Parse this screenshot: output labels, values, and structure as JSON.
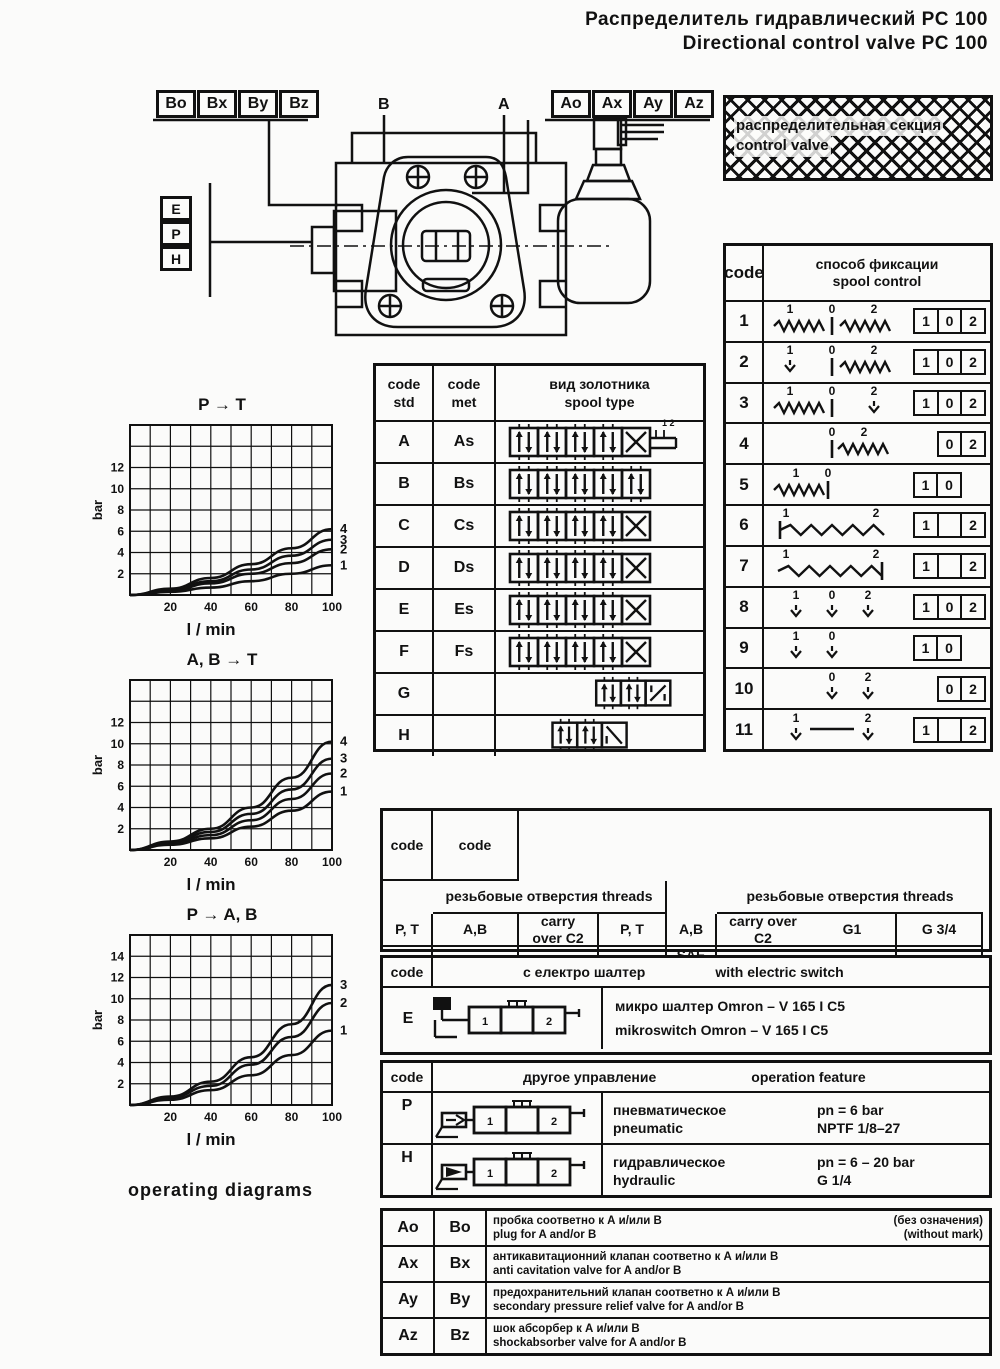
{
  "title": {
    "ru": "Распределитель гидравлический  PC 100",
    "en": "Directional control valve  PC 100"
  },
  "diagram": {
    "b_codes": [
      "Bo",
      "Bx",
      "By",
      "Bz"
    ],
    "a_codes": [
      "Ao",
      "Ax",
      "Ay",
      "Az"
    ],
    "port_b": "B",
    "port_a": "A",
    "control_codes": [
      "E",
      "P",
      "H"
    ],
    "section_label_ru": "распределительная секция",
    "section_label_en": "control valve"
  },
  "spool_control_table": {
    "header": {
      "code": "code",
      "ru": "способ фиксации",
      "en": "spool control"
    },
    "rows": [
      {
        "code": "1",
        "symbol": "spring-spring",
        "nums": [
          "1",
          "0",
          "2"
        ],
        "boxes": [
          "1",
          "0",
          "2"
        ],
        "align": "center"
      },
      {
        "code": "2",
        "symbol": "detent-spring",
        "nums": [
          "1",
          "0",
          "2"
        ],
        "boxes": [
          "1",
          "0",
          "2"
        ],
        "align": "center"
      },
      {
        "code": "3",
        "symbol": "spring-detent",
        "nums": [
          "1",
          "0",
          "2"
        ],
        "boxes": [
          "1",
          "0",
          "2"
        ],
        "align": "center"
      },
      {
        "code": "4",
        "symbol": "spring-right",
        "nums": [
          "0",
          "2"
        ],
        "boxes": [
          "0",
          "2"
        ],
        "align": "right"
      },
      {
        "code": "5",
        "symbol": "spring-left",
        "nums": [
          "1",
          "0"
        ],
        "boxes": [
          "1",
          "0"
        ],
        "align": "left"
      },
      {
        "code": "6",
        "symbol": "spring-wide",
        "nums": [
          "1",
          "2"
        ],
        "boxes": [
          "1",
          "",
          "2"
        ],
        "align": "center"
      },
      {
        "code": "7",
        "symbol": "spring-wide-bar",
        "nums": [
          "1",
          "2"
        ],
        "boxes": [
          "1",
          "",
          "2"
        ],
        "align": "center"
      },
      {
        "code": "8",
        "symbol": "detent-3",
        "nums": [
          "1",
          "0",
          "2"
        ],
        "boxes": [
          "1",
          "0",
          "2"
        ],
        "align": "center"
      },
      {
        "code": "9",
        "symbol": "detent-2l",
        "nums": [
          "1",
          "0"
        ],
        "boxes": [
          "1",
          "0"
        ],
        "align": "left"
      },
      {
        "code": "10",
        "symbol": "detent-2r",
        "nums": [
          "0",
          "2"
        ],
        "boxes": [
          "0",
          "2"
        ],
        "align": "right"
      },
      {
        "code": "11",
        "symbol": "detent-dash",
        "nums": [
          "1",
          "2"
        ],
        "boxes": [
          "1",
          "",
          "2"
        ],
        "align": "center"
      }
    ]
  },
  "spool_type_table": {
    "header": {
      "std": "code std",
      "met": "code met",
      "ru": "вид золотника",
      "en": "spool type"
    },
    "rows": [
      {
        "std": "A",
        "met": "As",
        "sym": "v5x-tail"
      },
      {
        "std": "B",
        "met": "Bs",
        "sym": "v5z"
      },
      {
        "std": "C",
        "met": "Cs",
        "sym": "v5x"
      },
      {
        "std": "D",
        "met": "Ds",
        "sym": "v5x"
      },
      {
        "std": "E",
        "met": "Es",
        "sym": "v5x"
      },
      {
        "std": "F",
        "met": "Fs",
        "sym": "v5x"
      },
      {
        "std": "G",
        "met": "",
        "sym": "v3z"
      },
      {
        "std": "H",
        "met": "",
        "sym": "v3n"
      }
    ]
  },
  "chart_data": [
    {
      "type": "line",
      "title": "P → T",
      "xlabel": "l / min",
      "ylabel": "bar",
      "xlim": [
        0,
        100
      ],
      "ylim": [
        0,
        16
      ],
      "xticks": [
        20,
        40,
        60,
        80,
        100
      ],
      "yticks": [
        2,
        4,
        6,
        8,
        10,
        12
      ],
      "x": [
        0,
        20,
        40,
        60,
        80,
        100
      ],
      "grid": true,
      "legend_position": "right",
      "series": [
        {
          "name": "4",
          "values": [
            0,
            0.6,
            1.6,
            2.9,
            4.4,
            6.2
          ]
        },
        {
          "name": "3",
          "values": [
            0,
            0.5,
            1.3,
            2.4,
            3.7,
            5.2
          ]
        },
        {
          "name": "2",
          "values": [
            0,
            0.4,
            1.1,
            2.0,
            3.0,
            4.3
          ]
        },
        {
          "name": "1",
          "values": [
            0,
            0.3,
            0.7,
            1.3,
            2.0,
            2.8
          ]
        }
      ]
    },
    {
      "type": "line",
      "title": "A, B → T",
      "xlabel": "l / min",
      "ylabel": "bar",
      "xlim": [
        0,
        100
      ],
      "ylim": [
        0,
        16
      ],
      "xticks": [
        20,
        40,
        60,
        80,
        100
      ],
      "yticks": [
        2,
        4,
        6,
        8,
        10,
        12
      ],
      "x": [
        0,
        20,
        40,
        60,
        80,
        100
      ],
      "grid": true,
      "legend_position": "right",
      "series": [
        {
          "name": "4",
          "values": [
            0,
            0.8,
            2.0,
            4.0,
            6.8,
            10.2
          ]
        },
        {
          "name": "3",
          "values": [
            0,
            0.7,
            1.7,
            3.4,
            5.7,
            8.6
          ]
        },
        {
          "name": "2",
          "values": [
            0,
            0.6,
            1.4,
            2.8,
            4.8,
            7.2
          ]
        },
        {
          "name": "1",
          "values": [
            0,
            0.5,
            1.1,
            2.2,
            3.7,
            5.5
          ]
        }
      ]
    },
    {
      "type": "line",
      "title": "P → A, B",
      "xlabel": "l / min",
      "ylabel": "bar",
      "xlim": [
        0,
        100
      ],
      "ylim": [
        0,
        16
      ],
      "xticks": [
        20,
        40,
        60,
        80,
        100
      ],
      "yticks": [
        2,
        4,
        6,
        8,
        10,
        12,
        14
      ],
      "x": [
        0,
        20,
        40,
        60,
        80,
        100
      ],
      "grid": true,
      "legend_position": "right",
      "series": [
        {
          "name": "3",
          "values": [
            0,
            0.8,
            2.2,
            4.5,
            7.6,
            11.3
          ]
        },
        {
          "name": "2",
          "values": [
            0,
            0.7,
            1.8,
            3.8,
            6.4,
            9.6
          ]
        },
        {
          "name": "1",
          "values": [
            0,
            0.5,
            1.4,
            2.8,
            4.7,
            7.0
          ]
        }
      ]
    }
  ],
  "threads_table": {
    "header_code": "code",
    "header_ru": "резьбовые отверстия",
    "header_en": "threads",
    "sub_pt": "P, T",
    "sub_ab": "A,B",
    "sub_carry": "carry over C2",
    "left_rows": [
      {
        "code": "G1",
        "pt": "G 3/4",
        "ab": "G 1/2",
        "carry": "G 3/4"
      },
      {
        "code": "G2",
        "pt": "G 3/4",
        "ab": "G 3/4",
        "carry": "G 3/4"
      }
    ],
    "right_rows": [
      {
        "code": "S1",
        "pt": "SAE 12",
        "ab": "SAE 10",
        "carry": "SAE 12"
      },
      {
        "code": "S2",
        "pt": "SAE 12",
        "ab": "SAE 12",
        "carry": "SAE 12"
      }
    ]
  },
  "electric_table": {
    "header_code": "code",
    "header_ru": "с електро шалтер",
    "header_en": "with electric switch",
    "row_code": "E",
    "line_ru": "микро шалтер  Omron – V 165 I C5",
    "line_en": "mikroswitch Omron – V 165 I C5"
  },
  "operation_table": {
    "header_code": "code",
    "header_ru": "другое управление",
    "header_en": "operation feature",
    "rows": [
      {
        "code": "P",
        "ru": "пневматическое",
        "en": "pneumatic",
        "spec1": "pn = 6 bar",
        "spec2": "NPTF 1/8–27"
      },
      {
        "code": "H",
        "ru": "гидравлическое",
        "en": "hydraulic",
        "spec1": "pn = 6 – 20 bar",
        "spec2": "G 1/4"
      }
    ]
  },
  "options_table": {
    "rows": [
      {
        "a": "Ao",
        "b": "Bo",
        "ru": "пробка соответно к А и/или В",
        "ru2": "(без означения)",
        "en": "plug for A and/or B",
        "en2": "(without mark)"
      },
      {
        "a": "Ax",
        "b": "Bx",
        "ru": "антикавитационний клапан соответно к А и/или В",
        "ru2": "",
        "en": "anti cavitation valve for A and/or B",
        "en2": ""
      },
      {
        "a": "Ay",
        "b": "By",
        "ru": "предохранительний клапан соответно к А и/или В",
        "ru2": "",
        "en": "secondary pressure relief valve for A and/or B",
        "en2": ""
      },
      {
        "a": "Az",
        "b": "Bz",
        "ru": "шок абсорбер к А и/или В",
        "ru2": "",
        "en": "shockabsorber valve for A and/or B",
        "en2": ""
      }
    ]
  },
  "footer_label": "operating diagrams"
}
